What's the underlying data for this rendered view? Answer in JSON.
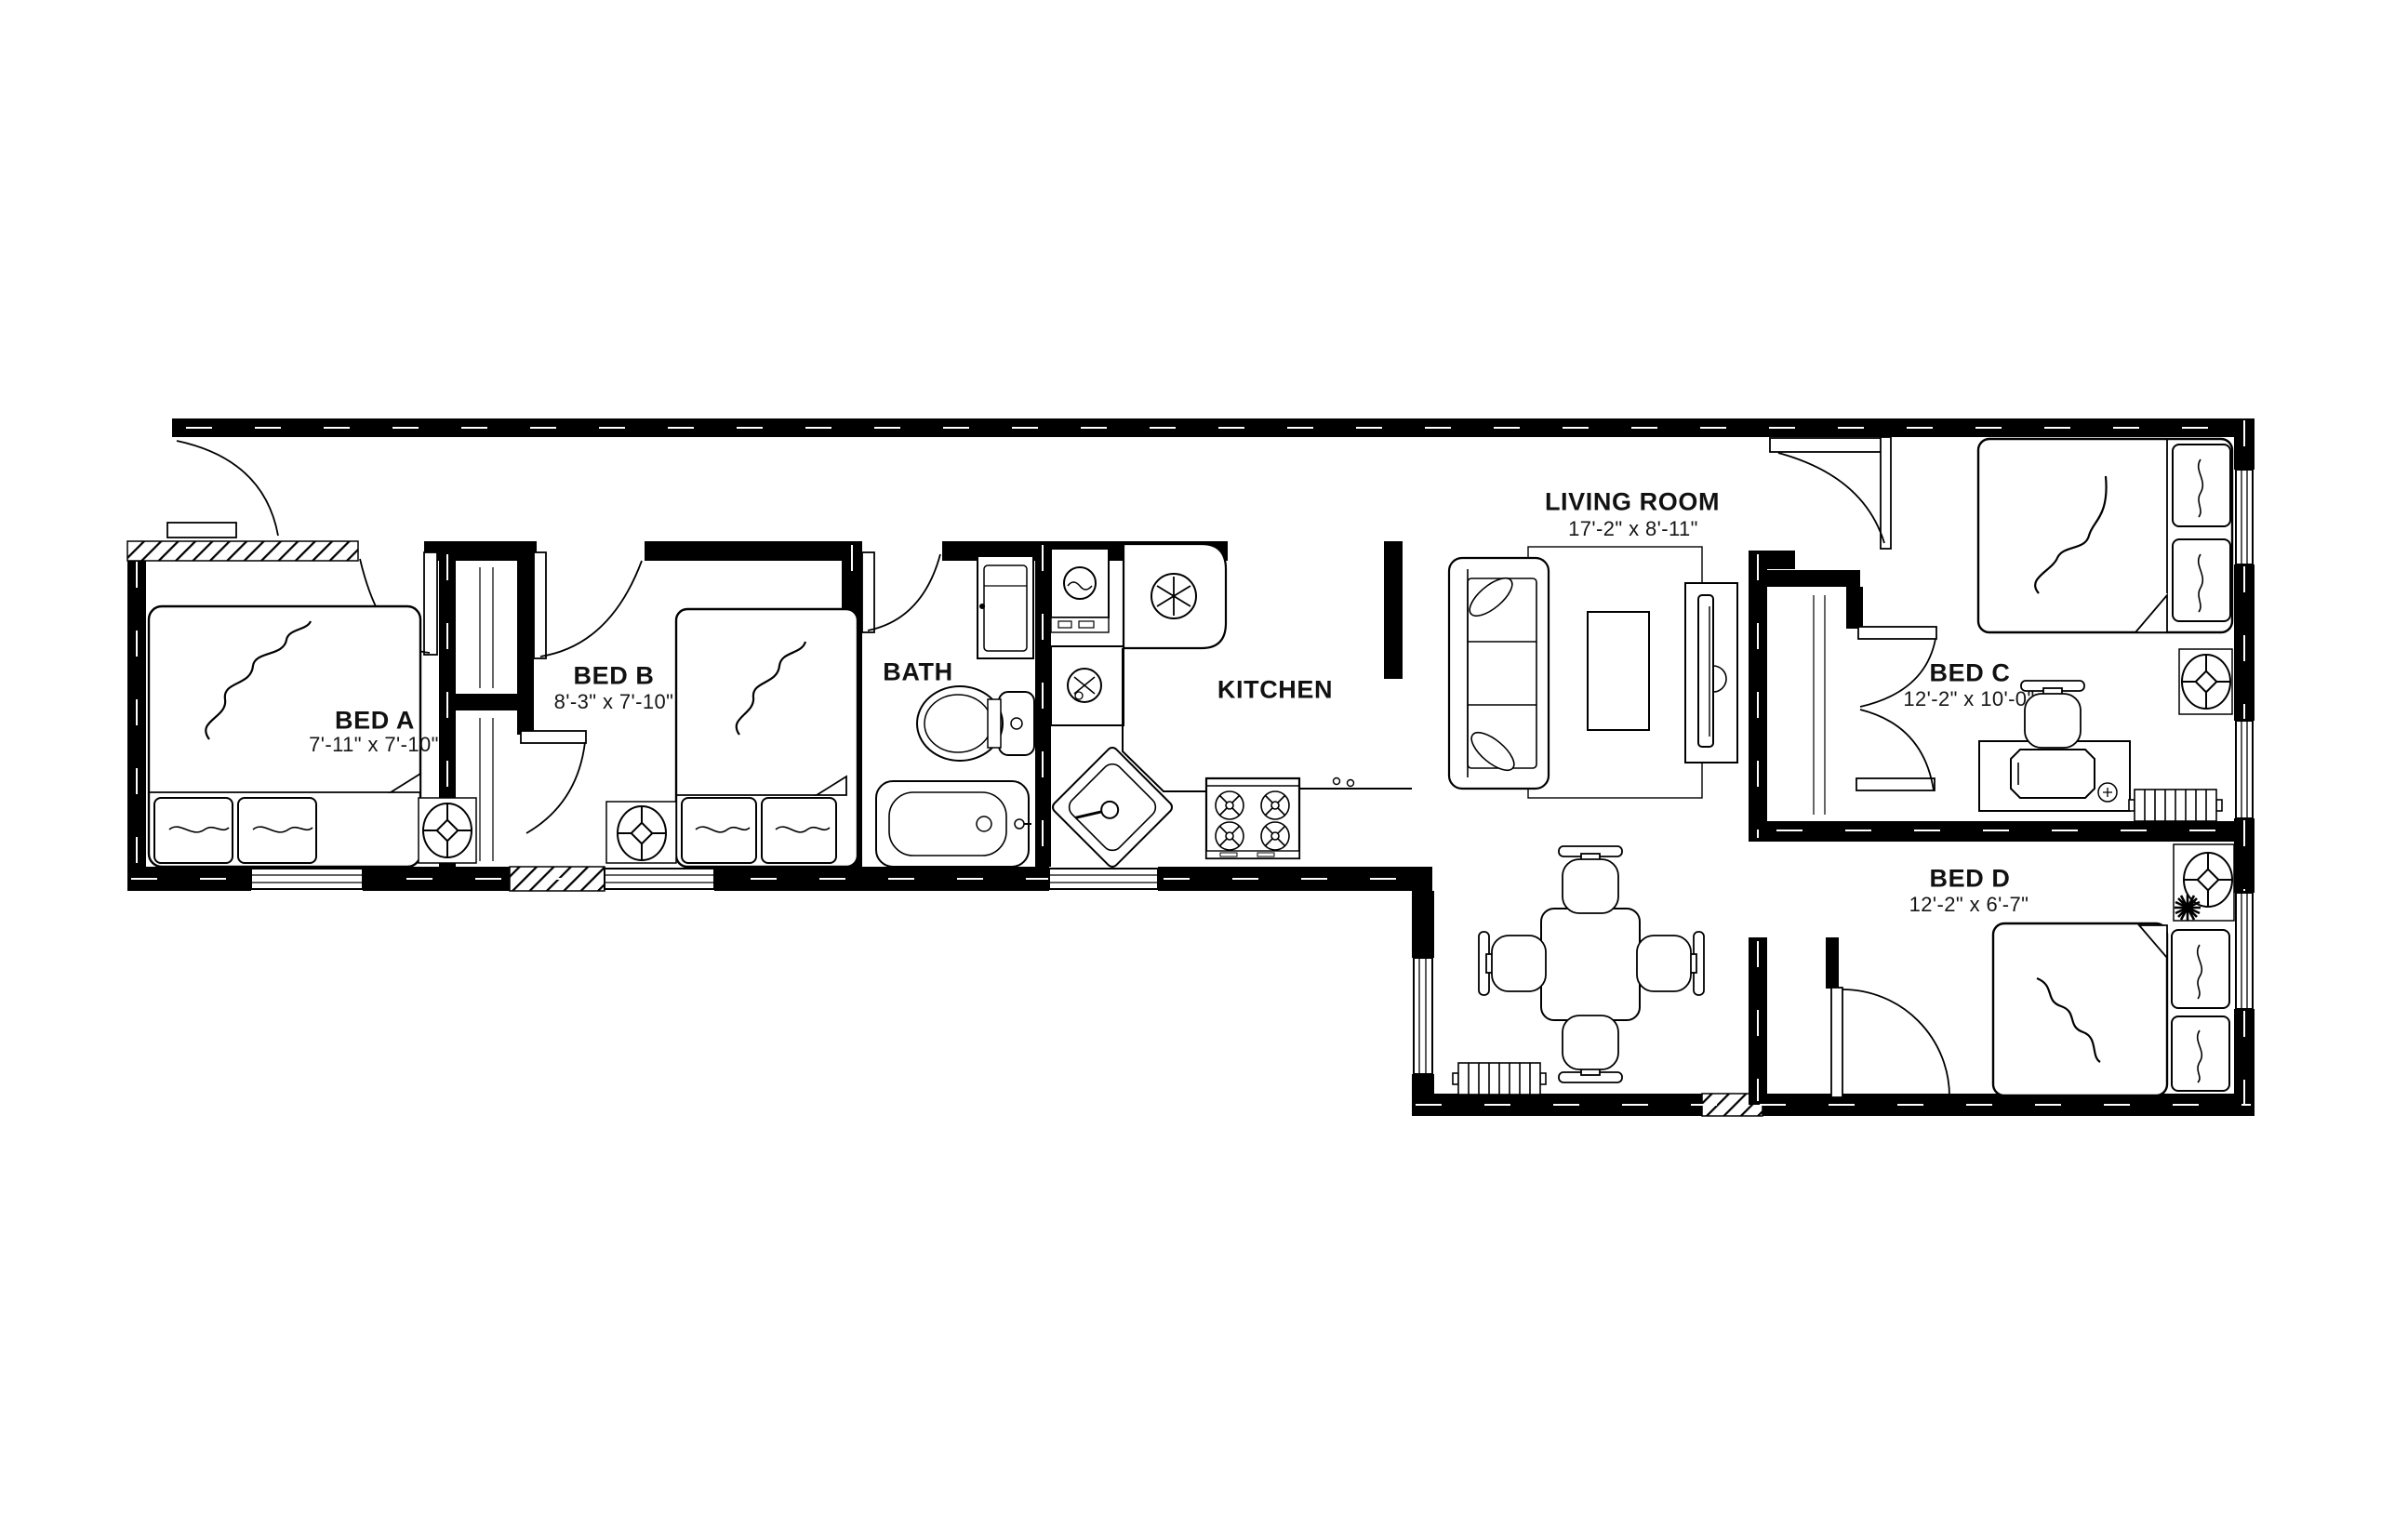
{
  "plan": {
    "type": "apartment-floor-plan",
    "colors": {
      "wall": "#000000",
      "background": "#ffffff",
      "text": "#111111"
    },
    "rooms": [
      {
        "id": "bed-a",
        "label": "BED A",
        "dimensions": "7'-11\" x 7'-10\""
      },
      {
        "id": "bed-b",
        "label": "BED B",
        "dimensions": "8'-3\" x 7'-10\""
      },
      {
        "id": "bath",
        "label": "BATH",
        "dimensions": ""
      },
      {
        "id": "kitchen",
        "label": "KITCHEN",
        "dimensions": ""
      },
      {
        "id": "living-room",
        "label": "LIVING ROOM",
        "dimensions": "17'-2\" x 8'-11\""
      },
      {
        "id": "bed-c",
        "label": "BED C",
        "dimensions": "12'-2\" x 10'-0\""
      },
      {
        "id": "bed-d",
        "label": "BED D",
        "dimensions": "12'-2\" x 6'-7\""
      }
    ]
  }
}
